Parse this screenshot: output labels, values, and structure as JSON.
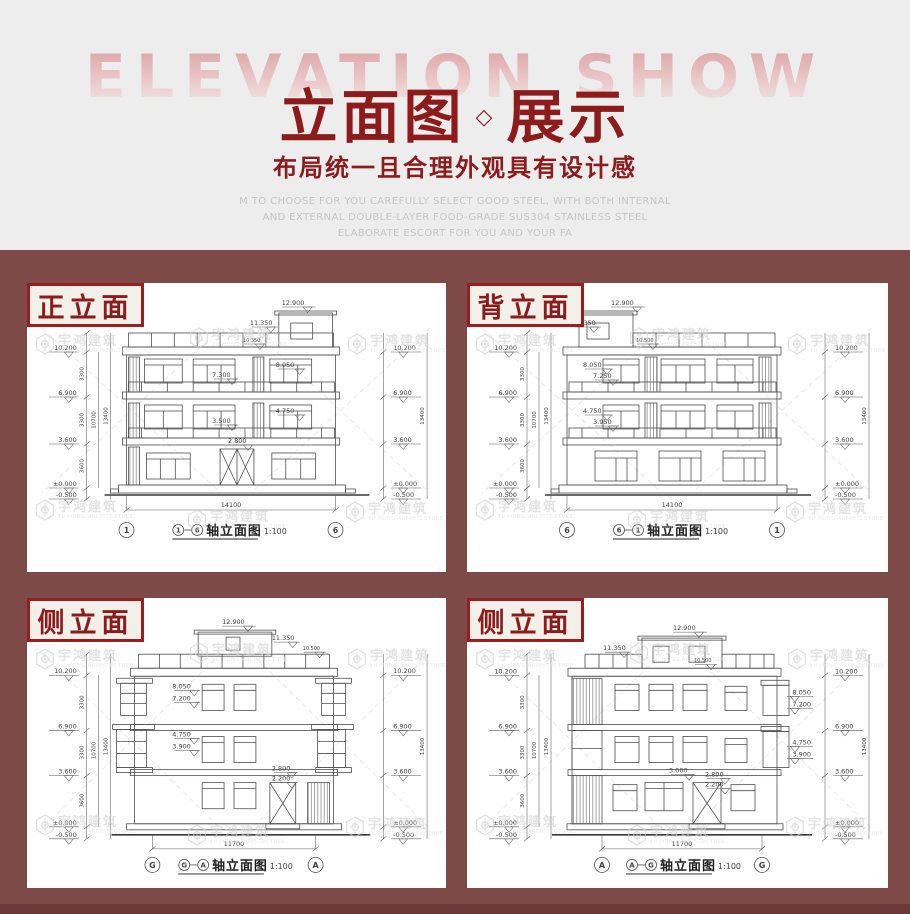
{
  "colors": {
    "bg_top": "#ededed",
    "bg_bottom": "#7d4a47",
    "bg_bottom_dark": "#6b3a38",
    "accent": "#8e1b1b",
    "badge_bg": "#f3f0ea"
  },
  "header": {
    "backdrop": "ELEVATION SHOW",
    "title_left": "立面图",
    "separator": "◇",
    "title_right": "展示",
    "subtitle": "布局统一且合理外观具有设计感",
    "desc1": "M TO CHOOSE FOR YOU CAREFULLY SELECT GOOD STEEL, WITH BOTH INTERNAL",
    "desc2": "AND EXTERNAL DOUBLE-LAYER FOOD-GRADE SUS304 STAINLESS STEEL",
    "desc3": "ELABORATE ESCORT FOR YOU AND YOUR FA"
  },
  "watermark": {
    "brand": "宇鸿建筑",
    "sub": "YU HONG ARCHITECTURE"
  },
  "panels": [
    {
      "badge": "正立面",
      "caption_body": "轴立面图",
      "scale": "1:100",
      "axis_left": "1",
      "axis_right": "6",
      "total_width": "14100",
      "levels": [
        "10.200",
        "6.900",
        "3.600",
        "±0.000",
        "-0.500"
      ],
      "chain": [
        "3300",
        "3300",
        "3600"
      ],
      "chain_sub": "10700",
      "chain_total": "13400",
      "marks": {
        "roof": "12.900",
        "rail": "11.350",
        "parapet": "10.350",
        "f3": "8.050",
        "f3b": "7.300",
        "f2": "4.750",
        "f2b": "3.500",
        "entry": "2.800"
      }
    },
    {
      "badge": "背立面",
      "caption_body": "轴立面图",
      "scale": "1:100",
      "axis_left": "6",
      "axis_right": "1",
      "total_width": "14100",
      "levels": [
        "10.200",
        "6.900",
        "3.600",
        "±0.000",
        "-0.500"
      ],
      "chain": [
        "3300",
        "3300",
        "3600"
      ],
      "chain_sub": "10700",
      "chain_total": "13400",
      "marks": {
        "roof": "12.900",
        "rail": "11.350",
        "parapet": "10.500",
        "f3": "8.050",
        "f3b": "7.250",
        "f2": "4.750",
        "f2b": "3.950"
      }
    },
    {
      "badge": "侧立面",
      "caption_body": "轴立面图",
      "scale": "1:100",
      "axis_left": "G",
      "axis_right": "A",
      "total_width": "11700",
      "levels": [
        "10.200",
        "6.900",
        "3.600",
        "±0.000",
        "-0.500"
      ],
      "chain": [
        "3300",
        "3300",
        "3600"
      ],
      "chain_sub": "10700",
      "chain_total": "13400",
      "marks": {
        "roof": "12.900",
        "rail": "11.350",
        "parapet": "10.500",
        "f3": "8.050",
        "f3b": "7.200",
        "f2": "4.750",
        "f2b": "3.900",
        "entry": "2.800",
        "entry2": "2.200"
      }
    },
    {
      "badge": "侧立面",
      "caption_body": "轴立面图",
      "scale": "1:100",
      "axis_left": "A",
      "axis_right": "G",
      "total_width": "11700",
      "levels": [
        "10.200",
        "6.900",
        "3.600",
        "±0.000",
        "-0.500"
      ],
      "chain": [
        "3300",
        "3300",
        "3600"
      ],
      "chain_sub": "10700",
      "chain_total": "13400",
      "marks": {
        "roof": "12.900",
        "rail": "11.350",
        "parapet": "10.500",
        "f3": "8.050",
        "f3b": "7.200",
        "f2": "4.750",
        "f2b": "3.900",
        "entry0": "3.000",
        "entry": "2.800",
        "entry2": "2.200"
      }
    }
  ]
}
